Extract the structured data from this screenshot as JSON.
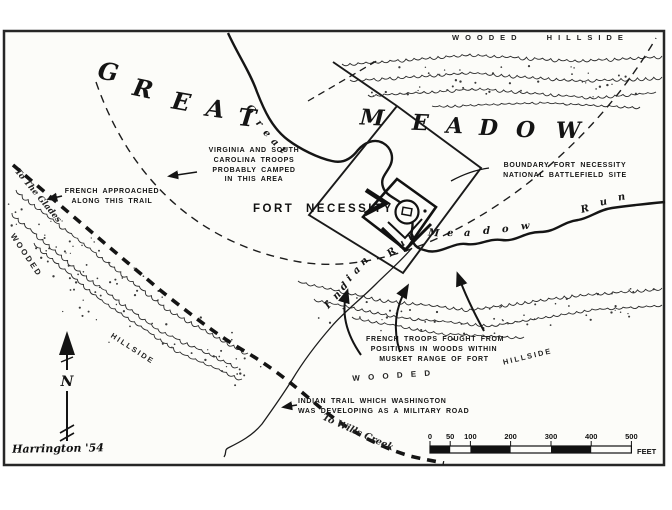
{
  "map": {
    "hillsides": {
      "top": "WOODED HILLSIDE",
      "left_wooded": "W O O D E D",
      "left_hillside": "H I L L S I D E",
      "bottom_wooded": "W O O D E D",
      "bottom_hillside": "H I L L S I D E"
    },
    "meadow_name": {
      "word1": "GREAT",
      "word2": "MEADOW"
    },
    "fort_label": "FORT NECESSITY",
    "annotations": {
      "camp": [
        "VIRGINIA AND SOUTH",
        "CAROLINA TROOPS",
        "PROBABLY CAMPED",
        "IN THIS AREA"
      ],
      "boundary": [
        "BOUNDARY FORT NECESSITY",
        "NATIONAL BATTLEFIELD SITE"
      ],
      "french_approach": [
        "FRENCH APPROACHED",
        "ALONG THIS TRAIL"
      ],
      "french_positions": [
        "FRENCH TROOPS FOUGHT FROM",
        "POSITIONS IN WOODS WITHIN",
        "MUSKET RANGE OF FORT"
      ],
      "indian_trail": [
        "INDIAN TRAIL WHICH WASHINGTON",
        "WAS DEVELOPING AS A MILITARY ROAD"
      ]
    },
    "streams": {
      "great_meadow_run": "Great Meadow Run",
      "indian_run": "Indian Run"
    },
    "trail_notes": {
      "northwest": "To The Glades",
      "southeast": "To Wills Creek"
    },
    "compass_n": "N",
    "scale_bar": {
      "ticks": [
        "0",
        "50",
        "100",
        "200",
        "300",
        "400",
        "500"
      ],
      "unit": "FEET"
    },
    "signature": "Harrington '54",
    "ink_color": "#1a1a1a",
    "paper_color": "#fcfcf9"
  }
}
